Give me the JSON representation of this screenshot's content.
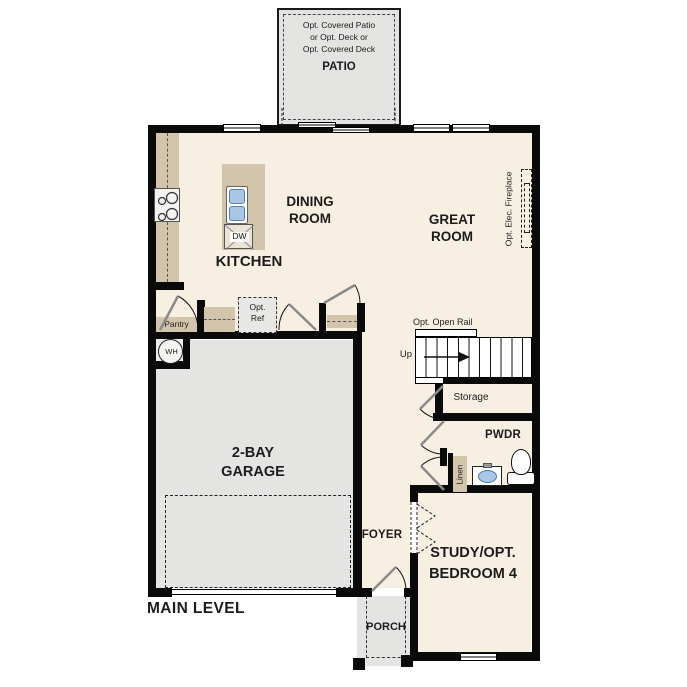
{
  "plan": {
    "title": "MAIN LEVEL",
    "colors": {
      "wall": "#0a0a0a",
      "interior_floor": "#f7f0e2",
      "concrete_floor": "#e4e4e2",
      "counter": "#d2c5ab",
      "fixture_blue": "#a9c7e4"
    },
    "rooms": {
      "patio": {
        "label": "PATIO",
        "note_lines": [
          "Opt. Covered Patio",
          "or Opt. Deck or",
          "Opt. Covered Deck"
        ]
      },
      "dining": {
        "lines": [
          "DINING",
          "ROOM"
        ]
      },
      "great": {
        "lines": [
          "GREAT",
          "ROOM"
        ]
      },
      "kitchen": {
        "label": "KITCHEN"
      },
      "pantry": {
        "label": "Pantry"
      },
      "garage": {
        "lines": [
          "2-BAY",
          "GARAGE"
        ]
      },
      "storage": {
        "label": "Storage"
      },
      "pwdr": {
        "label": "PWDR"
      },
      "linen": {
        "label": "Linen"
      },
      "foyer": {
        "label": "FOYER"
      },
      "study": {
        "lines": [
          "STUDY/OPT.",
          "BEDROOM 4"
        ]
      },
      "porch": {
        "label": "PORCH"
      }
    },
    "annotations": {
      "opt_ref_lines": [
        "Opt.",
        "Ref"
      ],
      "opt_fireplace": "Opt. Elec. Fireplace",
      "opt_open_rail": "Opt. Open Rail",
      "up": "Up",
      "dishwasher": "DW",
      "water_heater": "WH"
    }
  }
}
